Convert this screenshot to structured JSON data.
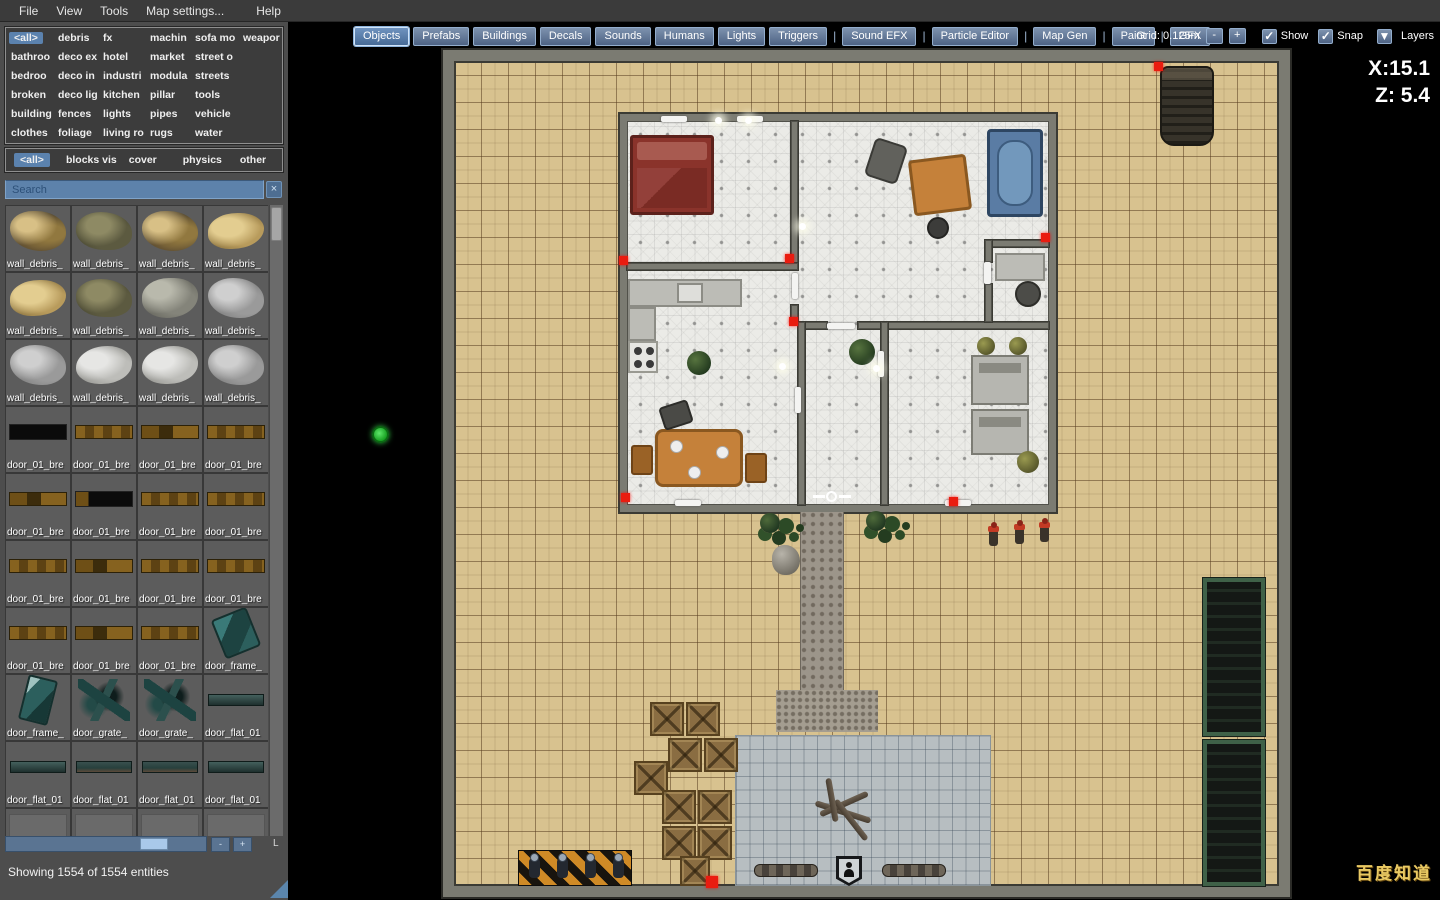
{
  "menu": {
    "items": [
      "File",
      "View",
      "Tools",
      "Map settings...",
      "Help"
    ]
  },
  "toolbar": {
    "buttons": [
      {
        "label": "Objects",
        "selected": true,
        "sep_after": false
      },
      {
        "label": "Prefabs",
        "selected": false,
        "sep_after": false
      },
      {
        "label": "Buildings",
        "selected": false,
        "sep_after": false
      },
      {
        "label": "Decals",
        "selected": false,
        "sep_after": false
      },
      {
        "label": "Sounds",
        "selected": false,
        "sep_after": false
      },
      {
        "label": "Humans",
        "selected": false,
        "sep_after": false
      },
      {
        "label": "Lights",
        "selected": false,
        "sep_after": false
      },
      {
        "label": "Triggers",
        "selected": false,
        "sep_after": true
      },
      {
        "label": "Sound EFX",
        "selected": false,
        "sep_after": true
      },
      {
        "label": "Particle Editor",
        "selected": false,
        "sep_after": true
      },
      {
        "label": "Map Gen",
        "selected": false,
        "sep_after": true
      },
      {
        "label": "Paint",
        "selected": false,
        "sep_after": true
      },
      {
        "label": "GFX",
        "selected": false,
        "sep_after": false
      }
    ],
    "separator": "|",
    "grid_label": "Grid: 0.125m",
    "grid_minus": "-",
    "grid_plus": "+",
    "check_icon": "✓",
    "show_label": "Show",
    "snap_label": "Snap",
    "layers_arrow": "▼",
    "layers_label": "Layers"
  },
  "coords": {
    "x": "X:15.1",
    "z": "Z: 5.4"
  },
  "sidebar": {
    "categories": {
      "selected": "<all>",
      "columns": [
        [
          "<all>",
          "bathroo",
          "bedroo",
          "broken",
          "building",
          "clothes"
        ],
        [
          "debris",
          "deco ex",
          "deco in",
          "deco lig",
          "fences",
          "foliage"
        ],
        [
          "fx",
          "hotel",
          "industri",
          "kitchen",
          "lights",
          "living ro"
        ],
        [
          "machin",
          "market",
          "modula",
          "pillar",
          "pipes",
          "rugs"
        ],
        [
          "sofa mo",
          "street o",
          "streets",
          "tools",
          "vehicle",
          "water"
        ],
        [
          "weapor",
          "",
          "",
          "",
          "",
          ""
        ]
      ]
    },
    "filters": {
      "selected": "<all>",
      "items": [
        "<all>",
        "blocks vis",
        "cover",
        "physics",
        "other"
      ],
      "margins": [
        8,
        16,
        12,
        26,
        18
      ]
    },
    "search": {
      "placeholder": "Search",
      "clear_icon": "×"
    },
    "assets": [
      {
        "label": "wall_debris_",
        "style": "debris-tan"
      },
      {
        "label": "wall_debris_",
        "style": "debris-olive"
      },
      {
        "label": "wall_debris_",
        "style": "debris-tan"
      },
      {
        "label": "wall_debris_",
        "style": "debris-gold"
      },
      {
        "label": "wall_debris_",
        "style": "debris-gold"
      },
      {
        "label": "wall_debris_",
        "style": "debris-olive"
      },
      {
        "label": "wall_debris_",
        "style": "debris-graygreen"
      },
      {
        "label": "wall_debris_",
        "style": "debris-gray"
      },
      {
        "label": "wall_debris_",
        "style": "debris-gray"
      },
      {
        "label": "wall_debris_",
        "style": "debris-white"
      },
      {
        "label": "wall_debris_",
        "style": "debris-white"
      },
      {
        "label": "wall_debris_",
        "style": "debris-gray"
      },
      {
        "label": "door_01_bre",
        "style": "door-black"
      },
      {
        "label": "door_01_bre",
        "style": "door-wood"
      },
      {
        "label": "door_01_bre",
        "style": "door-wood2"
      },
      {
        "label": "door_01_bre",
        "style": "door-wood"
      },
      {
        "label": "door_01_bre",
        "style": "door-wood2"
      },
      {
        "label": "door_01_bre",
        "style": "door-black2"
      },
      {
        "label": "door_01_bre",
        "style": "door-wood"
      },
      {
        "label": "door_01_bre",
        "style": "door-wood"
      },
      {
        "label": "door_01_bre",
        "style": "door-wood"
      },
      {
        "label": "door_01_bre",
        "style": "door-wood2"
      },
      {
        "label": "door_01_bre",
        "style": "door-wood"
      },
      {
        "label": "door_01_bre",
        "style": "door-wood"
      },
      {
        "label": "door_01_bre",
        "style": "door-wood"
      },
      {
        "label": "door_01_bre",
        "style": "door-wood2"
      },
      {
        "label": "door_01_bre",
        "style": "door-wood"
      },
      {
        "label": "door_frame_",
        "style": "frame-teal"
      },
      {
        "label": "door_frame_",
        "style": "frame-teal2"
      },
      {
        "label": "door_grate_",
        "style": "grate"
      },
      {
        "label": "door_grate_",
        "style": "grate"
      },
      {
        "label": "door_flat_01",
        "style": "flat"
      },
      {
        "label": "door_flat_01",
        "style": "flat"
      },
      {
        "label": "door_flat_01",
        "style": "flat2"
      },
      {
        "label": "door_flat_01",
        "style": "flat2"
      },
      {
        "label": "door_flat_01",
        "style": "flat"
      },
      {
        "label": "",
        "style": "blank"
      },
      {
        "label": "",
        "style": "blank"
      },
      {
        "label": "",
        "style": "blank"
      },
      {
        "label": "",
        "style": "blank"
      }
    ],
    "hscroll": {
      "minus": "-",
      "plus": "+",
      "l_label": "L"
    },
    "status": "Showing 1554 of 1554 entities"
  },
  "watermark": "百度知道",
  "colors": {
    "accent_blue": "#5b82ae",
    "button_blue": "#5d80ac",
    "sand": "#d8c28f",
    "marker_red": "#ea1c10"
  }
}
